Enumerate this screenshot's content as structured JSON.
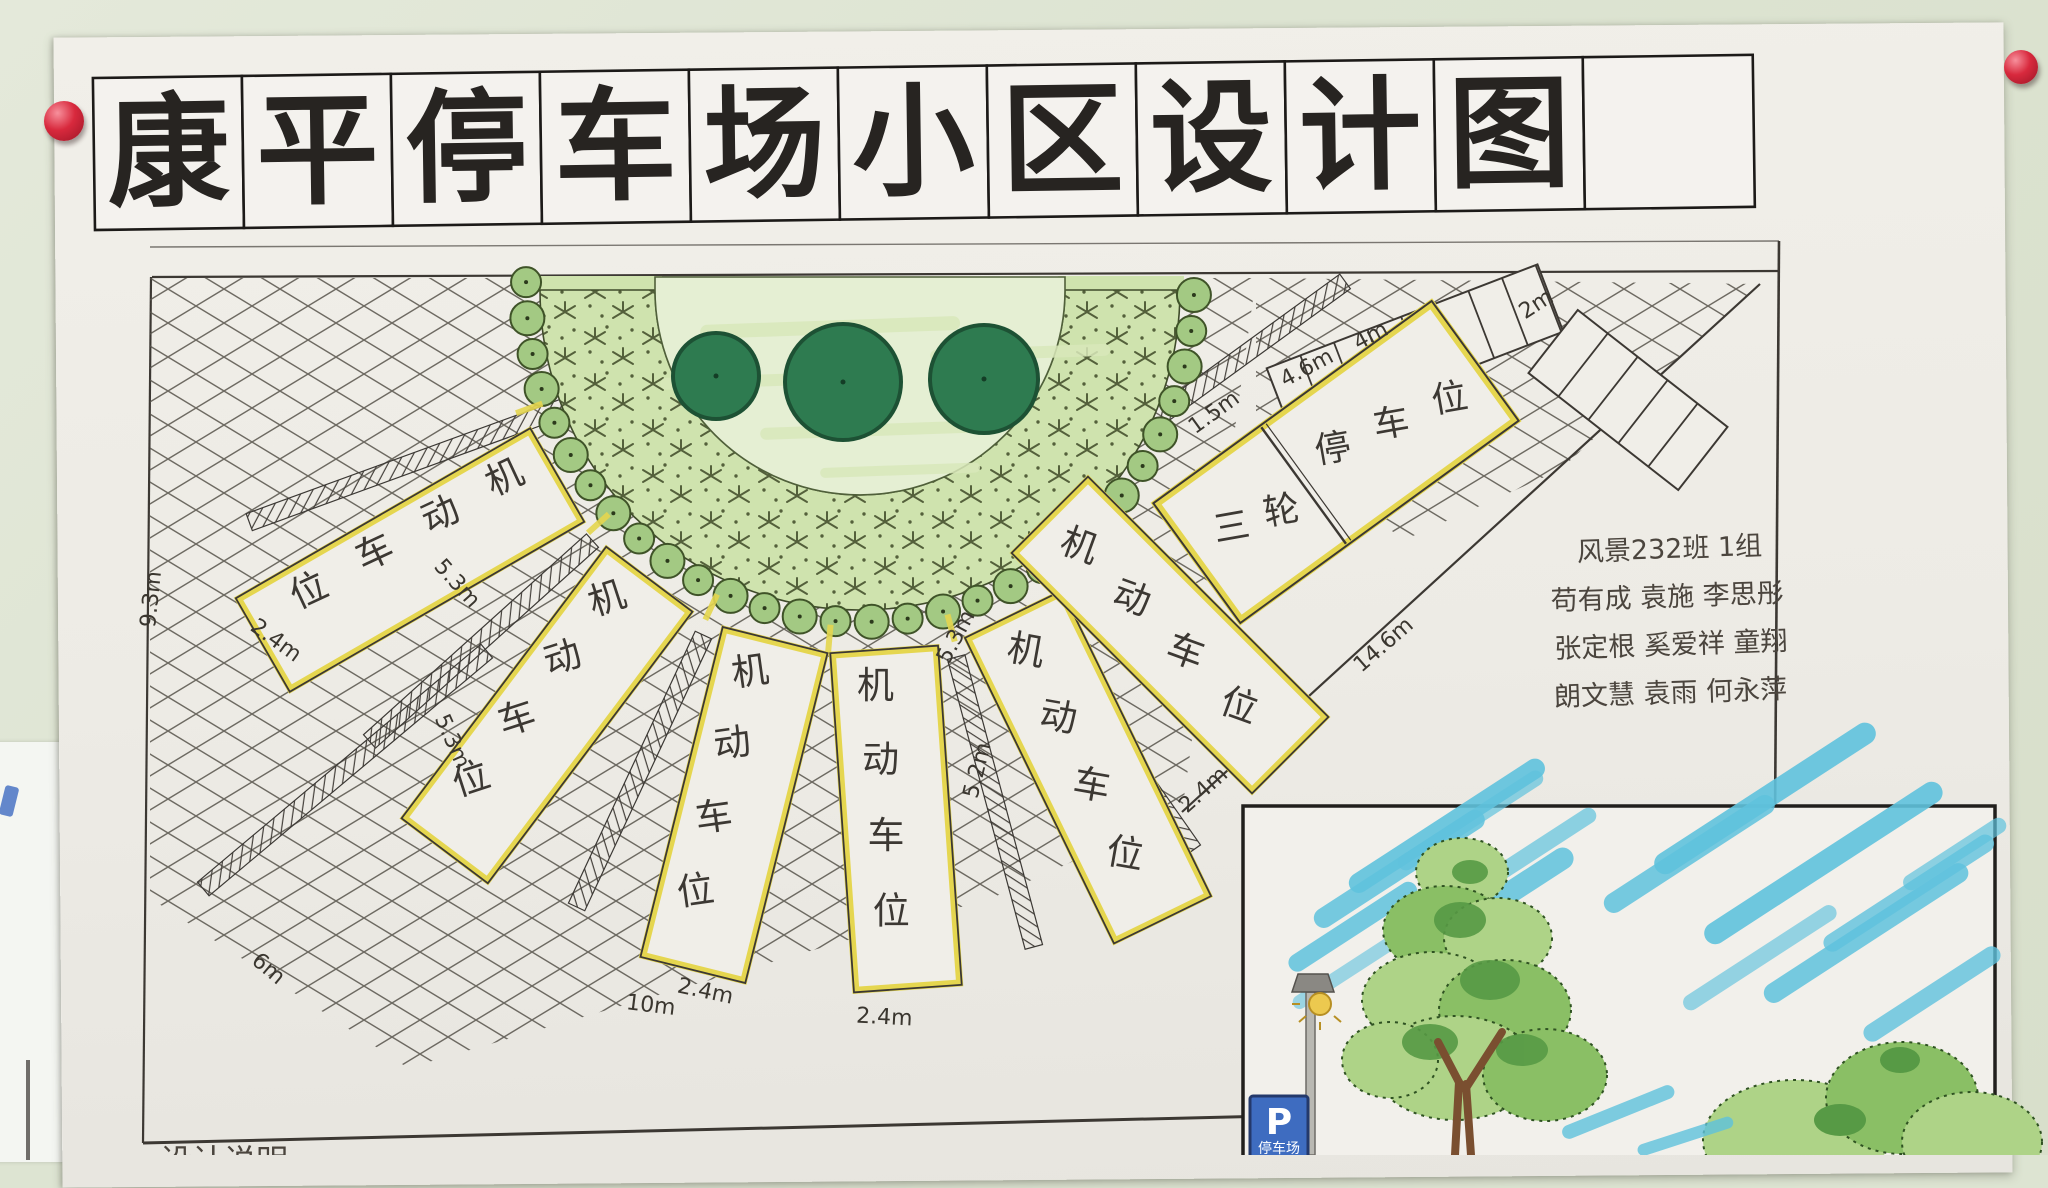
{
  "poster": {
    "title_text": "康平停车场小区设计图",
    "title_chars": [
      "康",
      "平",
      "停",
      "车",
      "场",
      "小",
      "区",
      "设",
      "计",
      "图"
    ]
  },
  "plan": {
    "stall_label": "机动车位",
    "stall_chars": [
      "机",
      "动",
      "车",
      "位"
    ],
    "tricycle_label": "三轮停车位",
    "tri_chars": [
      "三",
      "轮",
      "停",
      "车",
      "位"
    ],
    "dims": [
      "9.3m",
      "2.4m",
      "5.3m",
      "5.3m",
      "5.3m",
      "5.2m",
      "2.4m",
      "2.4m",
      "2.4m",
      "6m",
      "10m",
      "14.6m",
      "1.5m",
      "4.6m",
      "4m",
      "2m"
    ],
    "team": [
      "风景232班 1组",
      "苟有成 袁施 李思彤",
      "张定根 奚爱祥 童翔",
      "朗文慧 袁雨 何永萍"
    ],
    "bottom_note": "设计说明"
  },
  "inset": {
    "sign_p": "P",
    "sign_label": "停车场"
  },
  "colors": {
    "wall": "#dde4d2",
    "paper": "#f0eee8",
    "ink": "#3c3833",
    "title-ink": "#272421",
    "hl": "#e5d64f",
    "lawn": "#e5efd3",
    "cover": "#cfe3ae",
    "bush": "#a3c983",
    "bush-line": "#3f5328",
    "tree": "#2e7b50",
    "tree-line": "#1d5134",
    "sky": "#5fc2dd",
    "pin": "#d8293d",
    "sign-blue": "#3e6cc0",
    "foliage-light": "#aed387",
    "foliage-mid": "#8abf65",
    "foliage-dark": "#579a45",
    "trunk": "#7a4f30"
  }
}
